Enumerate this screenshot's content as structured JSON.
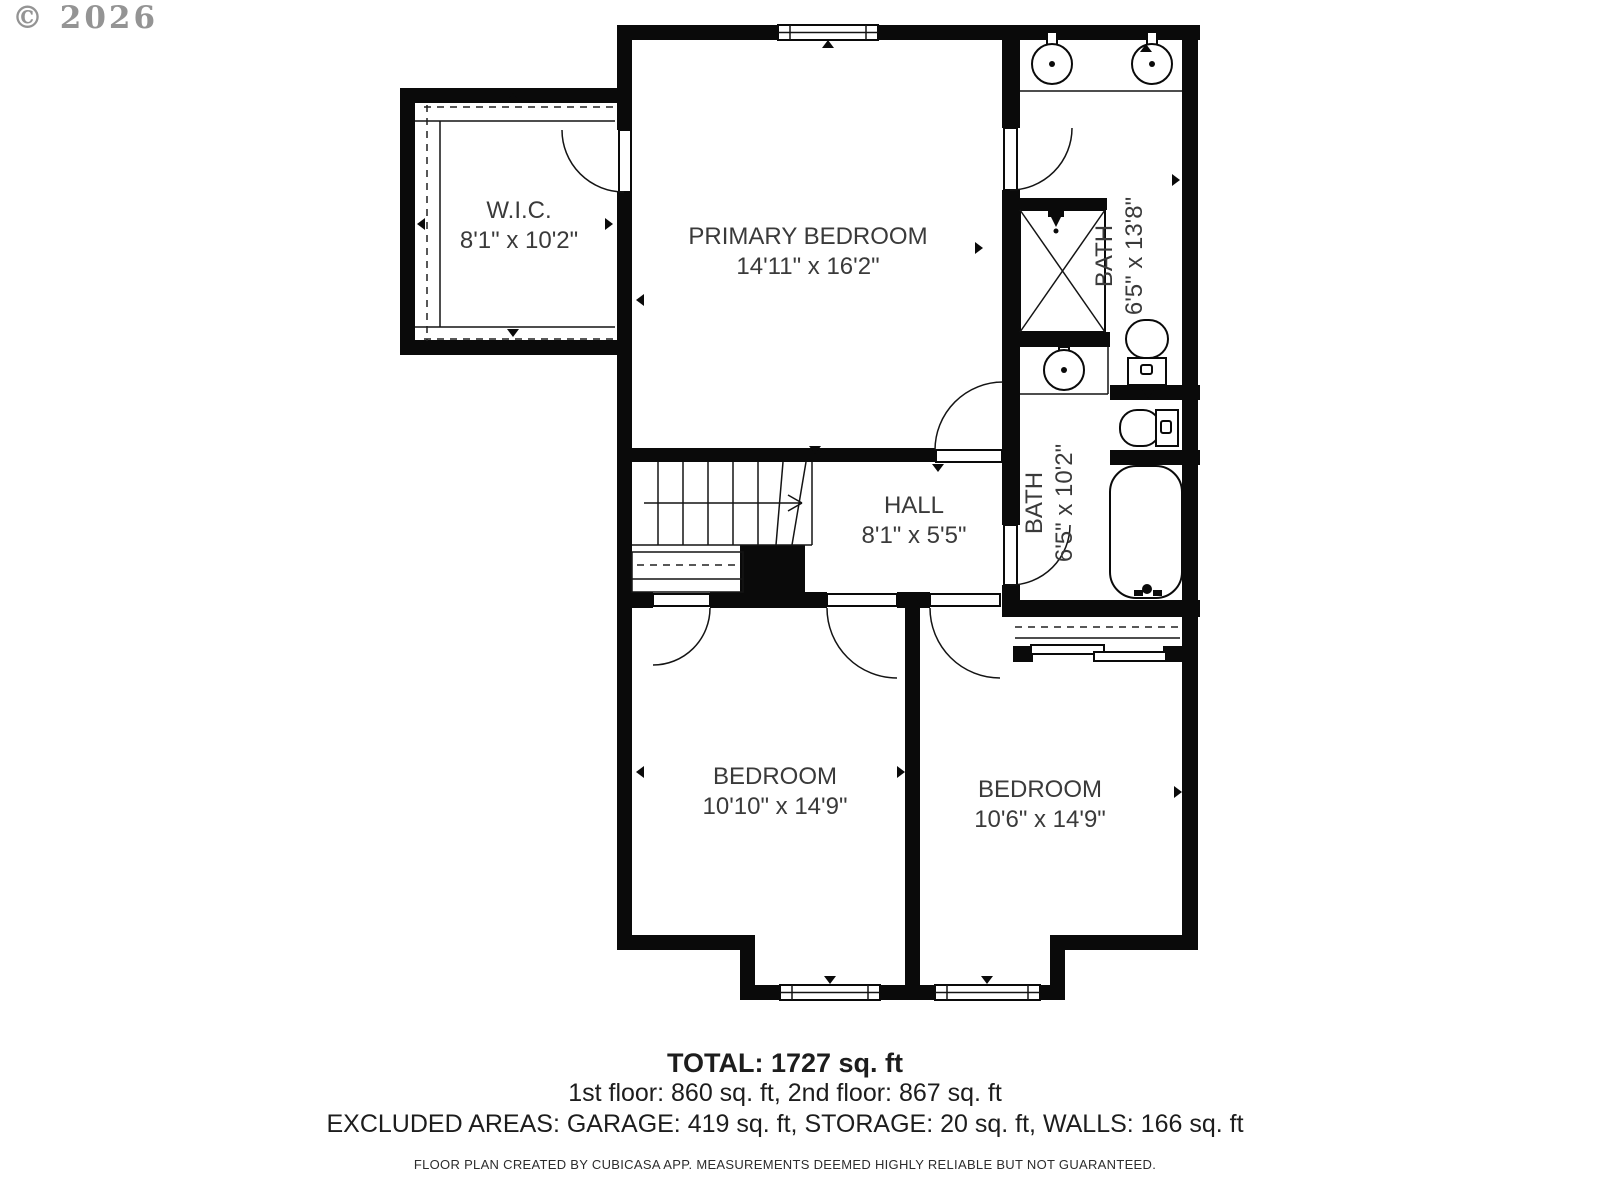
{
  "copyright": "© 2026",
  "rooms": {
    "wic": {
      "name": "W.I.C.",
      "dims": "8'1\" x 10'2\""
    },
    "primary_bedroom": {
      "name": "PRIMARY BEDROOM",
      "dims": "14'11\" x 16'2\""
    },
    "bath_upper": {
      "name": "BATH",
      "dims": "6'5\" x 13'8\""
    },
    "hall": {
      "name": "HALL",
      "dims": "8'1\" x 5'5\""
    },
    "bath_lower": {
      "name": "BATH",
      "dims": "6'5\" x 10'2\""
    },
    "bedroom_left": {
      "name": "BEDROOM",
      "dims": "10'10\" x 14'9\""
    },
    "bedroom_right": {
      "name": "BEDROOM",
      "dims": "10'6\" x 14'9\""
    }
  },
  "summary": {
    "total": "TOTAL: 1727 sq. ft",
    "floors": "1st floor: 860 sq. ft, 2nd floor: 867 sq. ft",
    "excluded": "EXCLUDED AREAS: GARAGE: 419 sq. ft, STORAGE: 20 sq. ft, WALLS: 166 sq. ft",
    "disclaimer": "FLOOR PLAN CREATED BY CUBICASA APP. MEASUREMENTS DEEMED HIGHLY RELIABLE BUT NOT GUARANTEED."
  },
  "colors": {
    "wall": "#0a0a0a",
    "label_text": "#3a3a3a",
    "copyright": "#949494"
  }
}
